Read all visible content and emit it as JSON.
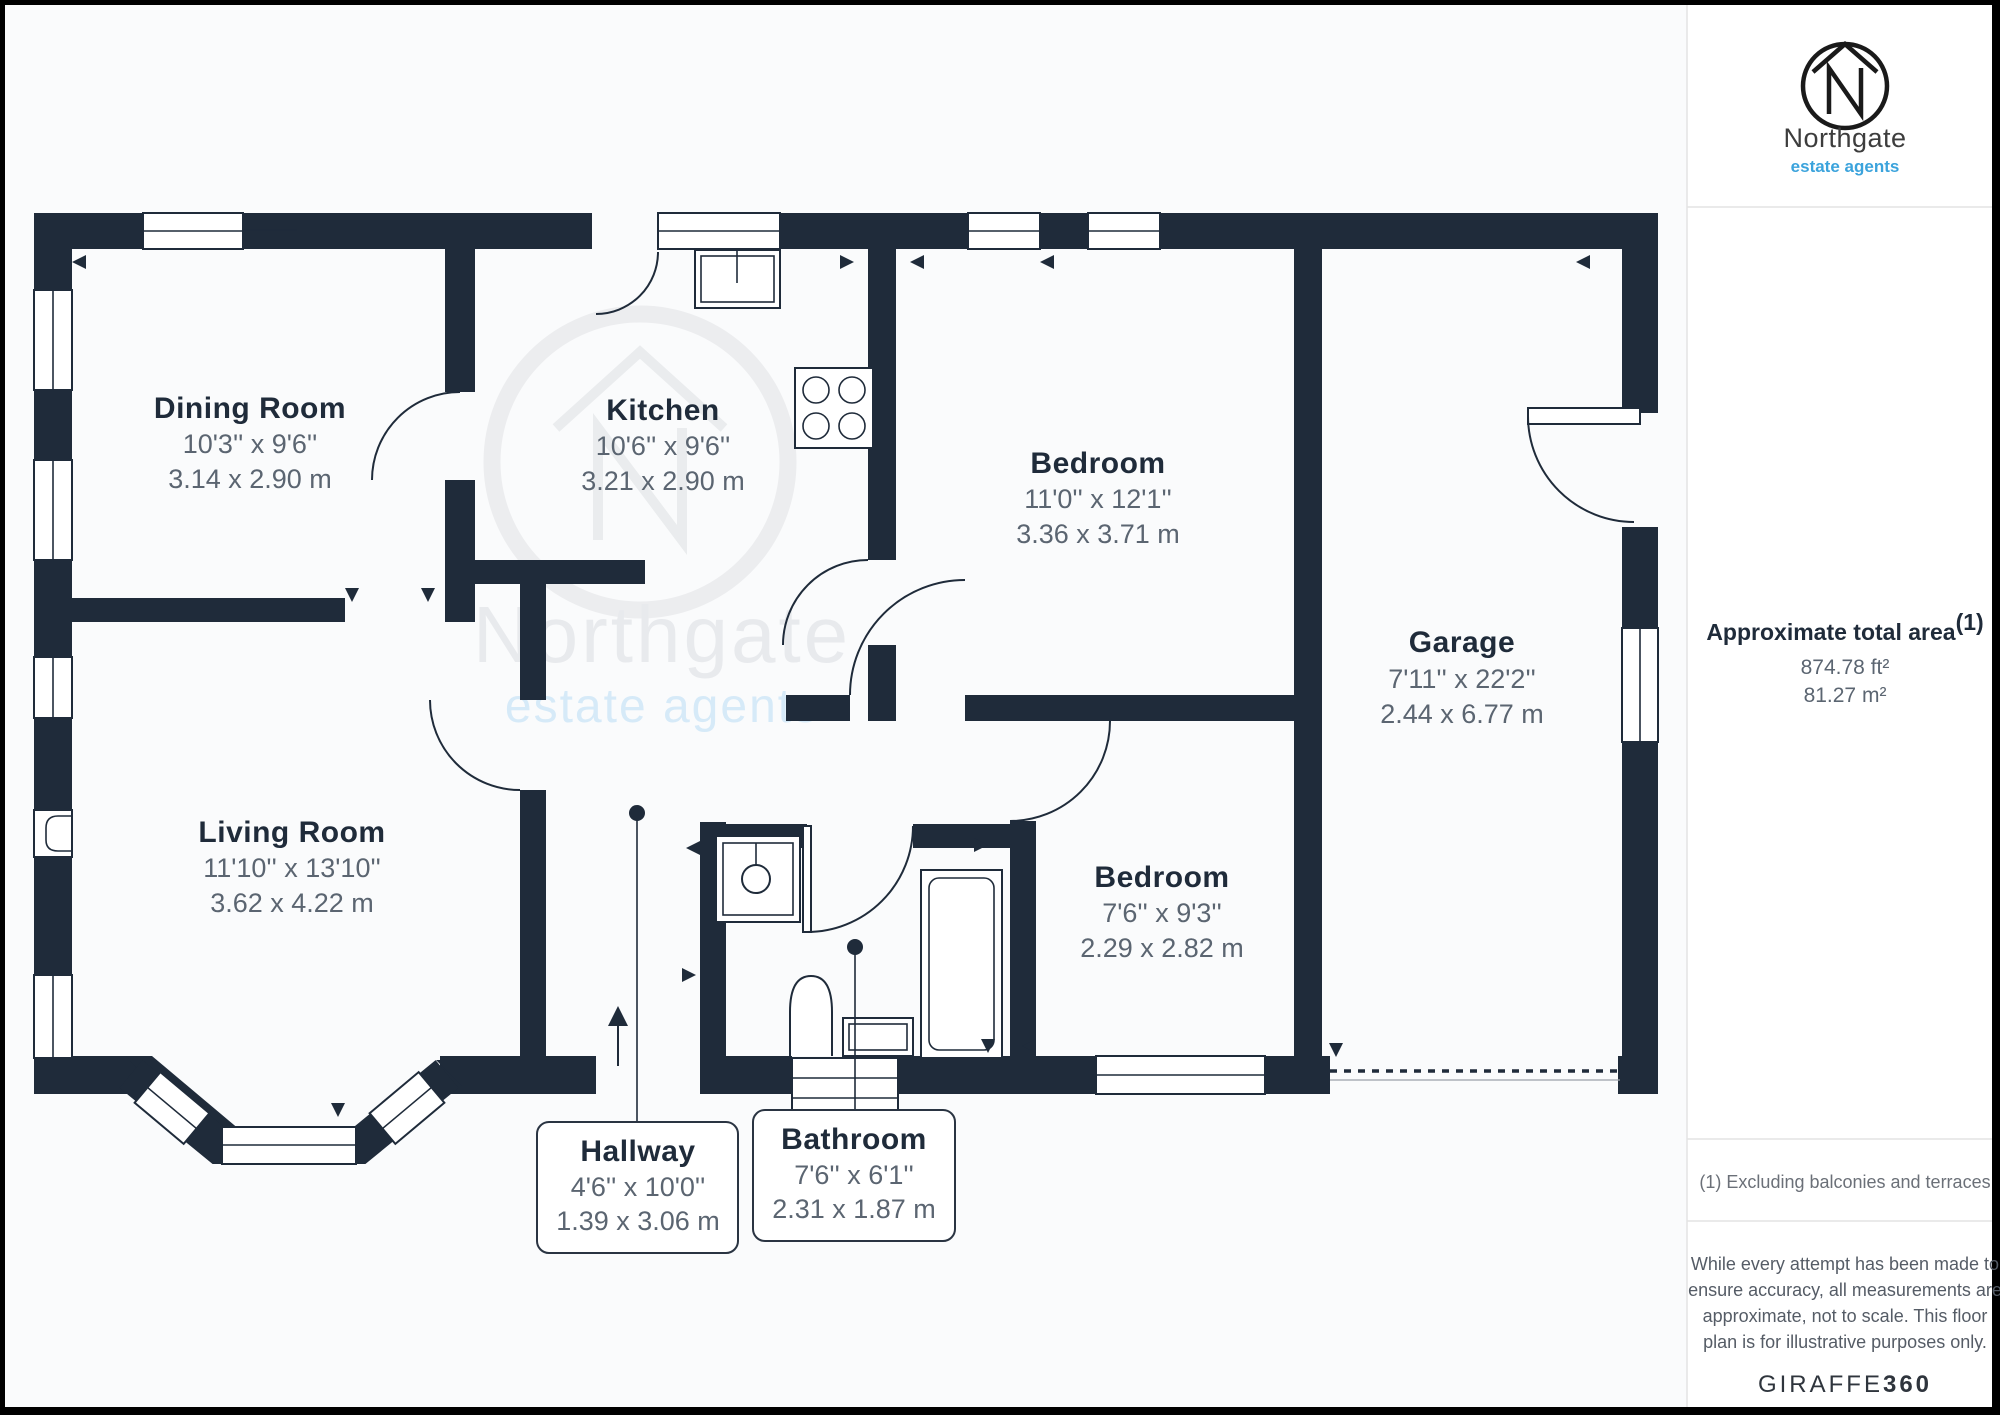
{
  "colors": {
    "wall": "#1f2b3a",
    "dimension_text": "#5b6571",
    "accent_blue": "#3ba3dc",
    "watermark_gray": "#e8eaed",
    "watermark_blue": "#d6eaf8"
  },
  "rooms": [
    {
      "name": "Dining Room",
      "imperial": "10'3'' x 9'6''",
      "metric": "3.14 x 2.90 m"
    },
    {
      "name": "Kitchen",
      "imperial": "10'6'' x 9'6''",
      "metric": "3.21 x 2.90 m"
    },
    {
      "name": "Bedroom",
      "imperial": "11'0'' x 12'1''",
      "metric": "3.36 x 3.71 m"
    },
    {
      "name": "Garage",
      "imperial": "7'11'' x 22'2''",
      "metric": "2.44 x 6.77 m"
    },
    {
      "name": "Living Room",
      "imperial": "11'10'' x 13'10''",
      "metric": "3.62 x 4.22 m"
    },
    {
      "name": "Bedroom",
      "imperial": "7'6'' x 9'3''",
      "metric": "2.29 x 2.82 m"
    },
    {
      "name": "Hallway",
      "imperial": "4'6'' x 10'0''",
      "metric": "1.39 x 3.06 m"
    },
    {
      "name": "Bathroom",
      "imperial": "7'6'' x 6'1''",
      "metric": "2.31 x 1.87 m"
    }
  ],
  "watermark": {
    "brand": "Northgate",
    "tagline": "estate agents"
  },
  "sidebar": {
    "logo": {
      "brand": "Northgate",
      "tagline": "estate agents"
    },
    "area": {
      "title": "Approximate total area",
      "superscript": "(1)",
      "imperial": "874.78 ft²",
      "metric": "81.27 m²"
    },
    "footnote": "(1) Excluding balconies and terraces",
    "disclaimer": {
      "lines": [
        "While every attempt has been made to",
        "ensure accuracy, all measurements are",
        "approximate, not to scale. This floor",
        "plan is for illustrative purposes only."
      ]
    },
    "credit": {
      "brand": "GIRAFFE",
      "suffix": "360"
    }
  }
}
